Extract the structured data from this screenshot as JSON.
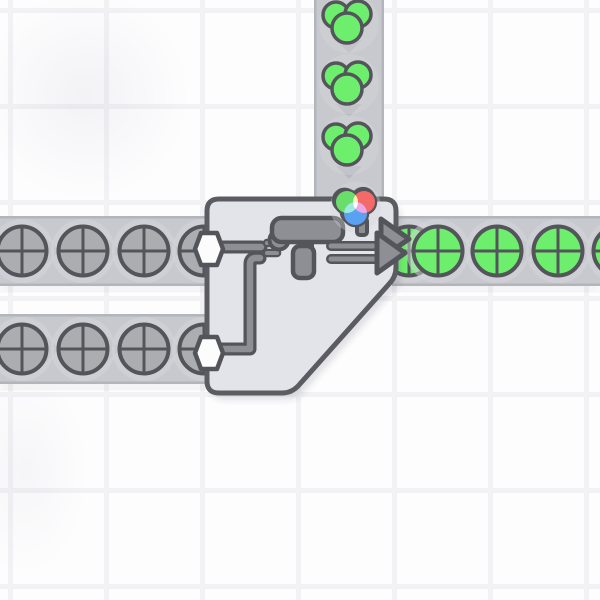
{
  "app": {
    "name": "shapez-factory-game",
    "view": "game-canvas"
  },
  "colors": {
    "bg": "#fdfdfe",
    "grid": "#f2f2f5",
    "belt": "#c8c9ce",
    "belt_edge": "#b4b5ba",
    "belt_shadow": "rgba(50,50,60,0.08)",
    "chevron": "#b9bac0",
    "pad": "#d6d7db",
    "outline": "#54555b",
    "item_gray": "#acadb1",
    "item_green": "#6dee6d",
    "building_fill": "#e3e4e9",
    "building_border": "#5b5c62",
    "building_shadow": "rgba(70,70,85,0.15)",
    "machine": "#8e8f95",
    "hex": "#fcfcfd",
    "wheel_red": "#f56969",
    "wheel_green": "#6ade6a",
    "wheel_blue": "#59a1f2",
    "mix_yellow": "#f2f6b4",
    "mix_cyan": "#9feade",
    "mix_magenta": "#eda7e2",
    "mix_white": "#fdfdfd"
  },
  "belts": [
    {
      "id": "paint-input-top",
      "x": 314,
      "y": 0,
      "w": 70,
      "h": 200,
      "dir": "down",
      "chevrons": [
        [
          349,
          46
        ],
        [
          349,
          110
        ],
        [
          349,
          172
        ]
      ]
    },
    {
      "id": "shape-input-left-1",
      "x": 0,
      "y": 216,
      "w": 208,
      "h": 70,
      "dir": "right",
      "chevrons": [
        [
          52,
          251
        ],
        [
          113,
          251
        ],
        [
          174,
          251
        ]
      ]
    },
    {
      "id": "output-right",
      "x": 392,
      "y": 216,
      "w": 208,
      "h": 70,
      "dir": "right",
      "chevrons": [
        [
          467,
          251
        ],
        [
          528,
          251
        ],
        [
          588,
          251
        ]
      ]
    },
    {
      "id": "shape-input-left-2",
      "x": 0,
      "y": 314,
      "w": 208,
      "h": 70,
      "dir": "right",
      "chevrons": [
        [
          52,
          349
        ],
        [
          113,
          349
        ],
        [
          174,
          349
        ]
      ]
    }
  ],
  "items": {
    "paint_blobs_green": [
      [
        349,
        23
      ],
      [
        349,
        84
      ],
      [
        349,
        145
      ]
    ],
    "gray_circle_shapes": [
      [
        22,
        251
      ],
      [
        83,
        251
      ],
      [
        144,
        251
      ],
      [
        204,
        251
      ],
      [
        22,
        349
      ],
      [
        83,
        349
      ],
      [
        144,
        349
      ],
      [
        204,
        349
      ]
    ],
    "green_circle_shapes": [
      [
        409,
        251
      ],
      [
        438,
        251
      ],
      [
        497,
        251
      ],
      [
        558,
        251
      ],
      [
        618,
        251
      ]
    ],
    "entering_paint_blob": {
      "x": 355.5,
      "y": 207,
      "scale": 0.85
    }
  },
  "building": {
    "type": "painter-double",
    "current_color": "green",
    "inputs": [
      [
        209,
        249
      ],
      [
        209,
        353
      ]
    ]
  }
}
